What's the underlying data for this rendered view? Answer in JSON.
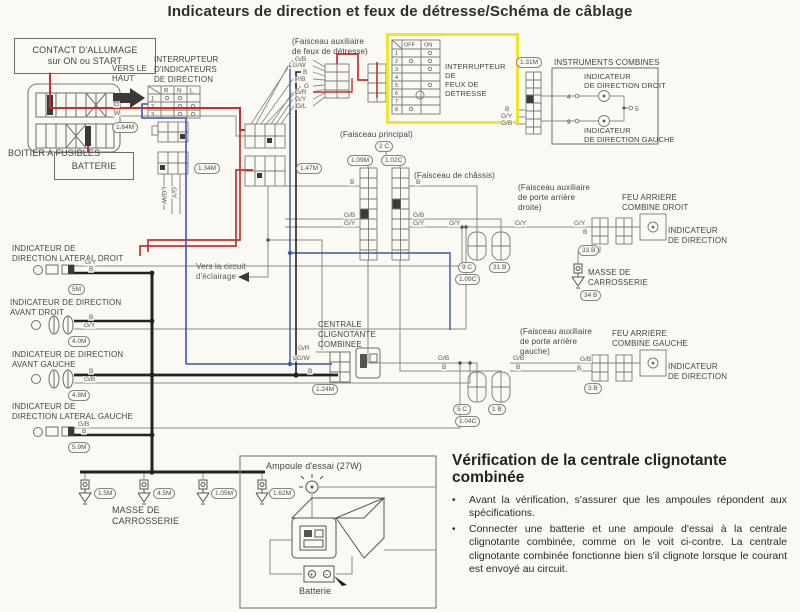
{
  "title": "Indicateurs de direction et feux de détresse/Schéma de câblage",
  "labels": {
    "contact_allumage": "CONTACT D'ALLUMAGE\nsur ON ou START",
    "vers_le_haut": "VERS LE\nHAUT",
    "interrupteur_indicateurs": "INTERRUPTEUR\nD'INDICATEURS\nDE DIRECTION",
    "boitier_fusibles": "BOITIER A FUSIBLES",
    "batterie": "BATTERIE",
    "faisceau_aux_detresse": "(Faisceau auxiliaire\nde feux de détresse)",
    "interrupteur_detresse": "INTERRUPTEUR DE\nFEUX DE DETRESSE",
    "instruments_combines": "INSTRUMENTS COMBINES",
    "indicateur_droit": "INDICATEUR\nDE DIRECTION DROIT",
    "indicateur_gauche": "INDICATEUR\nDE DIRECTION GAUCHE",
    "faisceau_principal": "(Faisceau principal)",
    "faisceau_chassis": "(Faisceau de châssis)",
    "faisceau_porte_droite": "(Faisceau auxiliaire\nde porte arrière\ndroite)",
    "feu_arriere_droit": "FEU ARRIERE\nCOMBINE DROIT",
    "indicateur_direction_d": "INDICATEUR\nDE DIRECTION",
    "masse_droite": "MASSE DE\nCARROSSERIE",
    "ind_lateral_droit": "INDICATEUR DE\nDIRECTION LATERAL DROIT",
    "ind_avant_droit": "INDICATEUR DE DIRECTION\nAVANT DROIT",
    "ind_avant_gauche": "INDICATEUR DE DIRECTION\nAVANT GAUCHE",
    "ind_lateral_gauche": "INDICATEUR DE\nDIRECTION LATERAL GAUCHE",
    "vers_eclairage": "Vers la circuit\nd'éclairage",
    "centrale": "CENTRALE\nCLIGNOTANTE\nCOMBINEE",
    "faisceau_porte_gauche": "(Faisceau auxiliaire\nde porte arrière\ngauche)",
    "feu_arriere_gauche": "FEU ARRIERE\nCOMBINE GAUCHE",
    "indicateur_direction_g": "INDICATEUR\nDE DIRECTION",
    "masse_bas": "MASSE DE\nCARROSSERIE"
  },
  "pills": {
    "c164m": "1.64M",
    "c134m": "1.34M",
    "c147m": "1.47M",
    "c131m": "1.31M",
    "c2c": "2 C",
    "c109m": "1.09M",
    "c102c": "1.02C",
    "c9c": "9 C",
    "c31b": "31 B",
    "c109c": "1.09C",
    "c33b": "33 B",
    "c34b": "34 B",
    "c5c": "5 C",
    "c1b": "1 B",
    "c104c": "1.04C",
    "c3b": "3 B",
    "c5m": "5M",
    "c40m": "4.0M",
    "c48m": "4.8M",
    "c59m": "5.9M",
    "c124m": "1.24M",
    "c15m": "1.5M",
    "c45m": "4.5M",
    "c105m": "1.05M",
    "c162m": "1.62M"
  },
  "wirelabels": [
    "G",
    "W",
    "G/B",
    "LG/W",
    "B",
    "P/B",
    "G",
    "G/R",
    "G/Y",
    "G/L",
    "B",
    "G/Y",
    "G/B",
    "B",
    "G/B",
    "G/Y",
    "B",
    "G/B",
    "G/Y",
    "G/Y",
    "G/Y",
    "G/Y",
    "B",
    "G/B",
    "B",
    "G/B",
    "B",
    "G/B",
    "B",
    "G/R",
    "LG/W",
    "B",
    "G/Y",
    "B",
    "B",
    "G/Y",
    "B",
    "G/B",
    "G/B",
    "B",
    "LG/W",
    "G/Y"
  ],
  "tables": {
    "dir_header": [
      "R",
      "N",
      "L"
    ],
    "dir_rows": [
      "1",
      "2",
      "3"
    ],
    "haz_header": [
      "OFF",
      "ON"
    ],
    "haz_rows": [
      "1",
      "2",
      "3",
      "4",
      "5",
      "6",
      "7",
      "8"
    ]
  },
  "instruments": {
    "pins": [
      "4",
      "9",
      "5"
    ]
  },
  "test_box": {
    "ampoule": "Ampoule d'essai (27W)",
    "batterie": "Batterie",
    "plus": "+",
    "minus": "−"
  },
  "verification": {
    "heading": "Vérification de la centrale clignotante combinée",
    "bullet_char": "•",
    "bullets": [
      "Avant la vérification, s'assurer que les ampoules répondent aux spécifications.",
      "Connecter une batterie et une ampoule d'essai à la centrale clignotante combinée, comme on le voit ci-contre. La centrale clignotante combinée fonctionne bien s'il clignote lorsque le courant est envoyé au circuit."
    ]
  },
  "colors": {
    "wire_red": "#c5302c",
    "wire_blue": "#4056a8",
    "wire_black": "#222222",
    "wire_gray": "#8b8b85",
    "highlight_yellow": "#f0e42c",
    "paper": "#faf9f4"
  }
}
